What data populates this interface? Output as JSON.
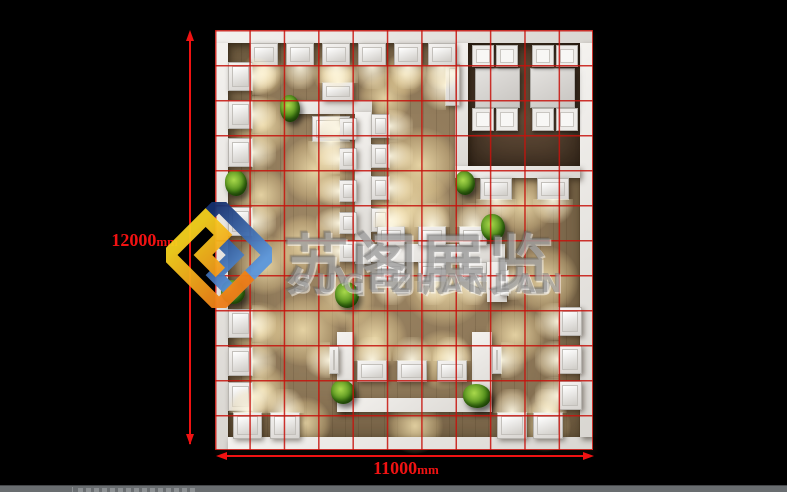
{
  "scene": {
    "background": "#000000",
    "statusbar_color": "#696d70"
  },
  "watermark": {
    "brand_cn": "苏阁展览",
    "brand_en": "SUGEZHANLAN",
    "text_color": "rgba(126,126,126,0.52)",
    "logo_colors": {
      "blue_dark": "#16316f",
      "blue_light": "#5b97dd",
      "yellow": "#f5d11e",
      "orange": "#ee7d18"
    }
  },
  "dimensions": {
    "color": "#f01212",
    "vertical": {
      "value": "12000",
      "unit": "mm"
    },
    "horizontal": {
      "value": "11000",
      "unit": "mm"
    }
  },
  "plan": {
    "grid_color": "rgba(198,18,12,0.85)",
    "grid_cols": 11,
    "grid_rows": 12,
    "floor_color": "#8d7758",
    "fixtures": [
      [
        "roomfloor",
        "meeting-room-floor",
        253,
        13,
        112,
        123
      ],
      [
        "poolfx",
        "meeting-room-light",
        262,
        36,
        40,
        40
      ],
      [
        "poolfx",
        "meeting-room-light",
        318,
        36,
        40,
        40
      ],
      [
        "wall",
        "outer-wall-top",
        0,
        0,
        378,
        13
      ],
      [
        "wall",
        "outer-wall-left",
        0,
        13,
        13,
        407
      ],
      [
        "wall",
        "outer-wall-bottom",
        13,
        407,
        365,
        13
      ],
      [
        "wall",
        "outer-wall-right",
        365,
        13,
        13,
        394
      ],
      [
        "wall",
        "meeting-room-wall-left",
        240,
        13,
        13,
        135
      ],
      [
        "wall",
        "meeting-room-wall-bottom",
        240,
        136,
        125,
        12
      ],
      [
        "table",
        "meeting-table",
        260,
        38,
        43,
        38
      ],
      [
        "table",
        "meeting-table",
        315,
        38,
        43,
        38
      ],
      [
        "chair",
        "meeting-chair",
        257,
        15,
        20,
        20
      ],
      [
        "chair",
        "meeting-chair",
        281,
        15,
        20,
        20
      ],
      [
        "chair",
        "meeting-chair",
        317,
        15,
        20,
        20
      ],
      [
        "chair",
        "meeting-chair",
        341,
        15,
        20,
        20
      ],
      [
        "chair",
        "meeting-chair",
        257,
        78,
        20,
        21
      ],
      [
        "chair",
        "meeting-chair",
        281,
        78,
        20,
        21
      ],
      [
        "chair",
        "meeting-chair",
        317,
        78,
        20,
        21
      ],
      [
        "chair",
        "meeting-chair",
        341,
        78,
        20,
        21
      ],
      [
        "counter gd",
        "display-counter",
        265,
        148,
        30,
        20
      ],
      [
        "counter gd",
        "display-counter",
        322,
        148,
        30,
        20
      ],
      [
        "counter gl",
        "display-counter",
        230,
        34,
        13,
        40
      ],
      [
        "wall-seg",
        "display-wall",
        75,
        70,
        82,
        14
      ],
      [
        "counter gu",
        "display-counter",
        107,
        52,
        30,
        17
      ],
      [
        "counter gd",
        "display-counter",
        97,
        86,
        36,
        24
      ],
      [
        "wall-seg",
        "display-wall",
        140,
        82,
        16,
        152
      ],
      [
        "counter gl",
        "display-counter",
        124,
        88,
        16,
        20
      ],
      [
        "counter gl",
        "display-counter",
        124,
        118,
        16,
        20
      ],
      [
        "counter gl",
        "display-counter",
        124,
        150,
        16,
        20
      ],
      [
        "counter gl",
        "display-counter",
        124,
        182,
        16,
        20
      ],
      [
        "counter gl",
        "display-counter",
        124,
        210,
        16,
        20
      ],
      [
        "counter gr",
        "display-counter",
        156,
        84,
        17,
        22
      ],
      [
        "counter gr",
        "display-counter",
        156,
        114,
        17,
        22
      ],
      [
        "counter gr",
        "display-counter",
        156,
        146,
        17,
        22
      ],
      [
        "counter gr",
        "display-counter",
        156,
        178,
        17,
        22
      ],
      [
        "wall-seg",
        "display-wall",
        156,
        214,
        134,
        18
      ],
      [
        "counter gu",
        "display-counter",
        162,
        196,
        26,
        18
      ],
      [
        "counter gu",
        "display-counter",
        203,
        196,
        26,
        18
      ],
      [
        "counter gu",
        "display-counter",
        244,
        196,
        26,
        18
      ],
      [
        "counter gd",
        "display-counter",
        162,
        232,
        26,
        18
      ],
      [
        "counter gd",
        "display-counter",
        203,
        232,
        26,
        18
      ],
      [
        "counter gd",
        "display-counter",
        244,
        232,
        26,
        18
      ],
      [
        "wall-seg",
        "display-wall",
        272,
        232,
        20,
        40
      ],
      [
        "counter gr",
        "light-panel",
        285,
        240,
        7,
        24
      ],
      [
        "wall-seg",
        "display-wall",
        122,
        302,
        16,
        80
      ],
      [
        "wall-seg",
        "display-wall",
        257,
        302,
        20,
        80
      ],
      [
        "wall-seg",
        "display-wall",
        122,
        368,
        155,
        14
      ],
      [
        "counter gu",
        "display-counter",
        142,
        330,
        28,
        20
      ],
      [
        "counter gu",
        "display-counter",
        182,
        330,
        28,
        20
      ],
      [
        "counter gu",
        "display-counter",
        222,
        330,
        28,
        20
      ],
      [
        "counter gl",
        "light-panel",
        114,
        316,
        8,
        26
      ],
      [
        "counter gr",
        "light-panel",
        277,
        316,
        8,
        26
      ],
      [
        "counter gd",
        "display-counter",
        35,
        13,
        26,
        21
      ],
      [
        "counter gd",
        "display-counter",
        71,
        13,
        26,
        21
      ],
      [
        "counter gd",
        "display-counter",
        107,
        13,
        26,
        21
      ],
      [
        "counter gd",
        "display-counter",
        143,
        13,
        26,
        21
      ],
      [
        "counter gd",
        "display-counter",
        179,
        13,
        26,
        21
      ],
      [
        "counter gd",
        "display-counter",
        213,
        13,
        26,
        21
      ],
      [
        "counter gr",
        "display-counter",
        13,
        32,
        23,
        27
      ],
      [
        "counter gr",
        "display-counter",
        13,
        70,
        23,
        27
      ],
      [
        "counter gr",
        "display-counter",
        13,
        108,
        23,
        27
      ],
      [
        "counter gr",
        "display-counter",
        13,
        177,
        23,
        27
      ],
      [
        "counter gr",
        "display-counter",
        13,
        279,
        23,
        27
      ],
      [
        "counter gr",
        "display-counter",
        13,
        317,
        23,
        27
      ],
      [
        "counter gr",
        "display-counter",
        13,
        352,
        23,
        27
      ],
      [
        "counter gu",
        "display-counter",
        18,
        382,
        27,
        25
      ],
      [
        "counter gu",
        "display-counter",
        55,
        382,
        28,
        25
      ],
      [
        "counter gu",
        "display-counter",
        282,
        382,
        28,
        25
      ],
      [
        "counter gu",
        "display-counter",
        318,
        382,
        28,
        25
      ],
      [
        "counter gl",
        "display-counter",
        343,
        277,
        22,
        27
      ],
      [
        "counter gl",
        "display-counter",
        343,
        315,
        22,
        27
      ],
      [
        "counter gl",
        "display-counter",
        343,
        351,
        22,
        27
      ]
    ],
    "plants": [
      [
        65,
        65,
        20,
        27
      ],
      [
        10,
        140,
        22,
        26
      ],
      [
        6,
        250,
        24,
        24
      ],
      [
        120,
        252,
        24,
        26
      ],
      [
        266,
        184,
        24,
        27
      ],
      [
        116,
        350,
        24,
        24
      ],
      [
        248,
        354,
        28,
        24
      ],
      [
        240,
        141,
        20,
        24
      ]
    ],
    "lights": [
      [
        48,
        95,
        30
      ],
      [
        46,
        165,
        28
      ],
      [
        50,
        235,
        30
      ],
      [
        44,
        300,
        28
      ],
      [
        48,
        360,
        26
      ],
      [
        100,
        140,
        34
      ],
      [
        88,
        215,
        30
      ],
      [
        88,
        300,
        36
      ],
      [
        90,
        393,
        26
      ],
      [
        170,
        68,
        26
      ],
      [
        205,
        135,
        38
      ],
      [
        195,
        180,
        42
      ],
      [
        230,
        255,
        42
      ],
      [
        130,
        268,
        30
      ],
      [
        160,
        308,
        32
      ],
      [
        228,
        330,
        30
      ],
      [
        200,
        396,
        28
      ],
      [
        330,
        396,
        26
      ],
      [
        308,
        175,
        30
      ],
      [
        330,
        250,
        34
      ],
      [
        300,
        305,
        30
      ],
      [
        48,
        44,
        22
      ],
      [
        120,
        44,
        22
      ],
      [
        190,
        44,
        22
      ]
    ]
  }
}
